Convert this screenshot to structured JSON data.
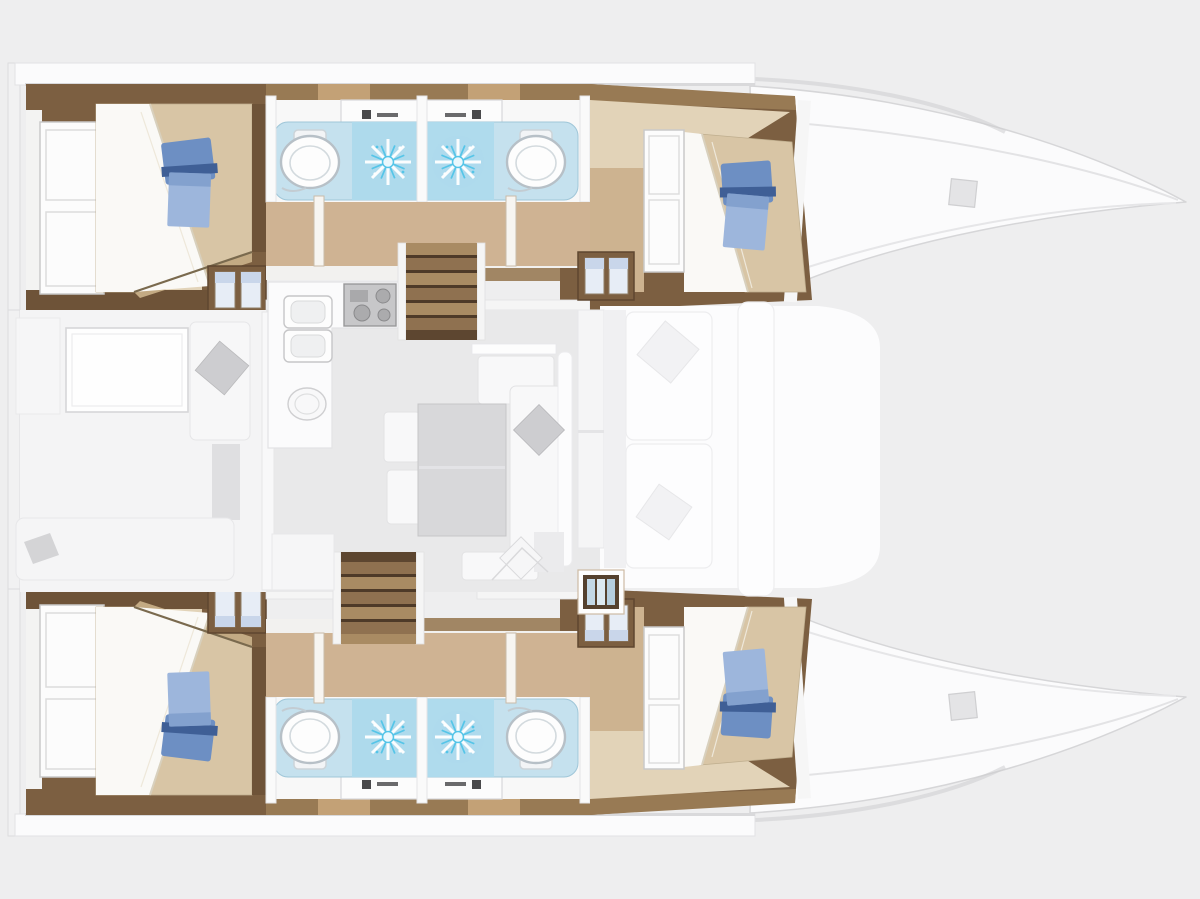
{
  "page": {
    "title": "Catamaran interior layout — deck plan",
    "type": "yacht floor plan",
    "orientation": "bow pointing right, stern at left",
    "visible_text": []
  },
  "colors": {
    "bg": "#eeeeef",
    "deck_white": "#fbfbfc",
    "hull_outline": "#d6d6d8",
    "wall_brown": "#7c5f41",
    "wood_dark": "#6e5338",
    "wood_mid": "#987a54",
    "step_light": "#a98b63",
    "step_dark": "#4e3a28",
    "bed_tan": "#d8c5a5",
    "bed_shadow": "#c3aa83",
    "sheet_white": "#faf9f6",
    "corridor_tan": "#cfb393",
    "shelf_tan": "#e2d3b8",
    "pillow_dark": "#6d8fc3",
    "pillow_light": "#9db6dc",
    "pillow_deep": "#3f5f96",
    "bath_floor": "#c5e1ee",
    "shower_tile": "#aedaec",
    "spray": "#55c5e8",
    "fixture_white": "#fdfdfd",
    "fixture_stroke": "#b7c0c7",
    "salon_floor": "#e9e9ea",
    "table_gray": "#d8d8da",
    "cushion_gray": "#cdcdd0",
    "furniture_white": "#f8f8f9",
    "furniture_stroke": "#e2e2e4",
    "cabinet_dark": "#55412e",
    "bottle_blue": "#c3d8e6",
    "locker_door": "#e7edf6"
  },
  "plan": {
    "vessel": "catamaran",
    "hull_count": 2,
    "cabin_count": 4,
    "bathroom_count": 4,
    "hulls": [
      {
        "id": "top-hull",
        "cabins": [
          {
            "position": "aft",
            "features": [
              "double-berth",
              "white-wardrobe",
              "storage-locker",
              "blue-towel-set"
            ]
          },
          {
            "position": "forward",
            "features": [
              "double-berth",
              "white-wardrobe",
              "storage-locker",
              "blue-towel-set"
            ]
          }
        ],
        "bathrooms": [
          {
            "position": "aft",
            "fixtures": [
              "toilet",
              "shower-spray",
              "sink-vanity"
            ]
          },
          {
            "position": "forward",
            "fixtures": [
              "toilet",
              "shower-spray",
              "sink-vanity"
            ]
          }
        ],
        "stairs": 1,
        "bow_hatch": 1
      },
      {
        "id": "bottom-hull",
        "cabins": [
          {
            "position": "aft",
            "features": [
              "double-berth",
              "white-wardrobe",
              "storage-locker",
              "blue-towel-set"
            ]
          },
          {
            "position": "forward",
            "features": [
              "double-berth",
              "white-wardrobe",
              "storage-locker",
              "blue-towel-set"
            ]
          }
        ],
        "bathrooms": [
          {
            "position": "aft",
            "fixtures": [
              "toilet",
              "shower-spray",
              "sink-vanity"
            ]
          },
          {
            "position": "forward",
            "fixtures": [
              "toilet",
              "shower-spray",
              "sink-vanity"
            ]
          }
        ],
        "stairs": 1,
        "bow_hatch": 1
      }
    ],
    "bridgedeck": {
      "saloon": [
        "dining-table",
        "l-sofa",
        "two-chairs",
        "bench-seat",
        "throw-cushions"
      ],
      "galley": [
        "double-square-sink",
        "round-sink",
        "stove-top",
        "bottle-cabinet"
      ],
      "aft_cockpit": [
        "cockpit-table",
        "bench-with-cushion",
        "aft-bench"
      ],
      "forward_cockpit": [
        "two-lounge-cushions",
        "forward-beam-seat"
      ]
    }
  }
}
